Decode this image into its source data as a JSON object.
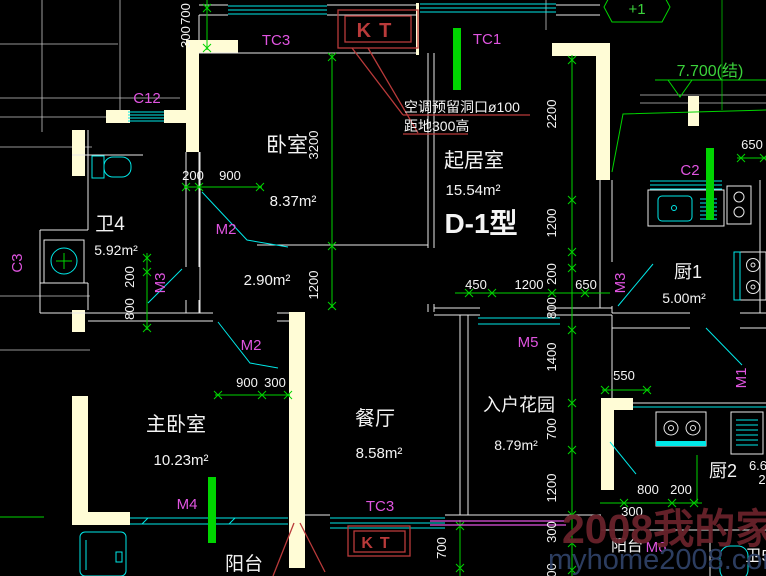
{
  "unit": {
    "type_label": "D-1型"
  },
  "rooms": {
    "bedroom": {
      "name": "卧室",
      "area": "8.37m²"
    },
    "hall": {
      "area": "2.90m²"
    },
    "living": {
      "name": "起居室",
      "area": "15.54m²"
    },
    "bath4": {
      "name": "卫4",
      "area": "5.92m²"
    },
    "master": {
      "name": "主卧室",
      "area": "10.23m²"
    },
    "dining": {
      "name": "餐厅",
      "area": "8.58m²"
    },
    "garden": {
      "name": "入户花园",
      "area": "8.79m²"
    },
    "kitchen1": {
      "name": "厨1",
      "area": "5.00m²"
    },
    "kitchen2": {
      "name": "厨2",
      "area_partial": "6.6",
      "area_partial2": "2"
    },
    "balcony_left": {
      "name": "阳台"
    },
    "balcony_right": {
      "name": "阳台"
    },
    "bath5": {
      "name": "卫5"
    }
  },
  "notes": {
    "ac1": "空调预留洞口ø100",
    "ac2": "距地300高",
    "elevation": "7.700(结)",
    "axis_bubble": "+1"
  },
  "tags": {
    "tc3_top": "TC3",
    "tc1": "TC1",
    "c12": "C12",
    "c2": "C2",
    "c3": "C3",
    "m1": "M1",
    "m2a": "M2",
    "m2b": "M2",
    "m3l": "M3",
    "m3r": "M3",
    "m4": "M4",
    "m5": "M5",
    "m6": "M6",
    "tc3_bottom": "TC3",
    "kt_top": "KT",
    "kt_bottom": "KT"
  },
  "dims": {
    "tl_700": "700",
    "tl_300": "300",
    "bed_3200": "3200",
    "bed_200": "200",
    "bed_900": "900",
    "bed_1200": "1200",
    "left_200": "200",
    "left_800": "800",
    "liv_450": "450",
    "liv_1200": "1200",
    "liv_650": "650",
    "chain_2200": "2200",
    "chain_1200a": "1200",
    "chain_200": "200",
    "chain_800": "800",
    "chain_1400": "1400",
    "chain_700": "700",
    "chain_1200b": "1200",
    "chain_300": "300",
    "chain_700b": "700",
    "tr_650": "650",
    "mid_550": "550",
    "m2b_900": "900",
    "m2b_300": "300",
    "k2_800": "800",
    "k2_200": "200",
    "k2_300": "300",
    "kt_700": "700"
  },
  "watermark": {
    "line1": "2008我的家",
    "line2": "myhome2008.com"
  },
  "colors": {
    "bg": "#000000",
    "wall": "#fffcd6",
    "line": "#e8e8e8",
    "cyan": "#00e8e8",
    "green": "#00d400",
    "green_text": "#3bd23b",
    "magenta": "#e054e0",
    "red": "#b93a3a",
    "text": "#f4f4f4",
    "watermark_red": "#69222b",
    "watermark_blue": "#2f4166"
  }
}
